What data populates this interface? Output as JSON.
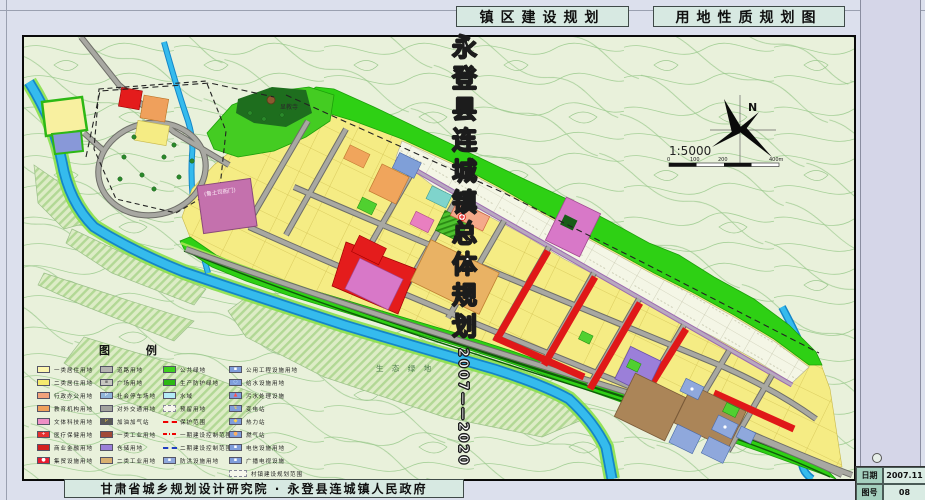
{
  "header": {
    "left_title": "镇区建设规划",
    "right_title": "用地性质规划图"
  },
  "sidebar": {
    "title": "永登县连城镇总体规划",
    "years": "2007——2020",
    "date_label": "日期",
    "date_value": "2007.11",
    "sheet_label": "图号",
    "sheet_value": "08"
  },
  "footer": {
    "credit": "甘肃省城乡规划设计研究院 · 永登县连城镇人民政府"
  },
  "map": {
    "north_label": "N",
    "scale_text": "1:5000",
    "scale_ticks": [
      "0",
      "100",
      "200",
      "400m"
    ],
    "labels": {
      "yamen": "(鲁土司衙门)",
      "temple": "显教寺",
      "eco": "生 态 绿 地"
    },
    "legend": {
      "title": "图    例",
      "columns": [
        {
          "items": [
            {
              "label": "一类居住用地",
              "bg": "#fdf6ae"
            },
            {
              "label": "二类居住用地",
              "bg": "#f5ea6e"
            },
            {
              "label": "行政办公用地",
              "bg": "#f2a27c"
            },
            {
              "label": "教育机构用地",
              "bg": "#efa05c"
            },
            {
              "label": "文体科技用地",
              "bg": "#ee8fc5"
            },
            {
              "label": "医疗保健用地",
              "bg": "#e63030",
              "icon": "+",
              "icon_color": "#ffffff"
            },
            {
              "label": "商业金融用地",
              "bg": "#d42020"
            },
            {
              "label": "集贸设施用地",
              "bg": "#e81c30",
              "icon": "●",
              "icon_color": "#ffffff"
            }
          ]
        },
        {
          "items": [
            {
              "label": "道路用地",
              "bg": "#b4b4b0"
            },
            {
              "label": "广场用地",
              "bg": "#c6c6c0",
              "icon": "▪",
              "icon_color": "#777777"
            },
            {
              "label": "社会停车场地",
              "bg": "#8fb4d8",
              "icon": "P",
              "icon_color": "#ffffff"
            },
            {
              "label": "对外交通用地",
              "bg": "#a2a29e"
            },
            {
              "label": "加油加气站",
              "bg": "#5a5a58",
              "icon": "P",
              "icon_color": "#ffd24a"
            },
            {
              "label": "一类工业用地",
              "bg": "#a04a38"
            },
            {
              "label": "仓储用地",
              "bg": "#9b7fd9"
            },
            {
              "label": "二类工业用地",
              "bg": "#d9b070"
            }
          ]
        },
        {
          "items": [
            {
              "label": "公共绿地",
              "bg": "#3ed01e"
            },
            {
              "label": "生产防护绿地",
              "bg": "#2db814"
            },
            {
              "label": "水域",
              "bg": "#b4ecf6"
            },
            {
              "label": "预留用地",
              "kind": "pale"
            },
            {
              "label": "保护范围",
              "kind": "line"
            },
            {
              "label": "一期建设控制范围",
              "kind": "dashdot"
            },
            {
              "label": "二期建设控制范围",
              "kind": "lineb"
            },
            {
              "label": "防洪设施用地",
              "bg": "#8fa8dc",
              "icon": "▪",
              "icon_color": "#ffffff"
            }
          ]
        },
        {
          "items": [
            {
              "label": "公用工程设施用地",
              "bg": "#7f9ddb",
              "icon": "▪",
              "icon_color": "#ffffff"
            },
            {
              "label": "给水设施用地",
              "bg": "#7f9ddb",
              "icon": "○",
              "icon_color": "#bfe8ff"
            },
            {
              "label": "污水处理设施",
              "bg": "#7f9ddb",
              "icon": "▲",
              "icon_color": "#ff5050"
            },
            {
              "label": "变电站",
              "bg": "#7f9ddb",
              "icon": "↯",
              "icon_color": "#ffd24a"
            },
            {
              "label": "热力站",
              "bg": "#7f9ddb",
              "icon": "◆",
              "icon_color": "#ffd24a"
            },
            {
              "label": "燃气站",
              "bg": "#7f9ddb",
              "icon": "●",
              "icon_color": "#ffb060"
            },
            {
              "label": "电信设施用地",
              "bg": "#7f9ddb",
              "icon": "▪",
              "icon_color": "#ffffff"
            },
            {
              "label": "广播电视设施",
              "bg": "#7f9ddb",
              "icon": "▪",
              "icon_color": "#ffffff"
            },
            {
              "label": "村镇建设规划范围",
              "kind": "pale",
              "wide": true
            }
          ]
        }
      ]
    }
  },
  "palette": {
    "sheet_bg": "#dce0ed",
    "titlebox_bg": "#d7e9e2",
    "sidebar_bg": "#d5d6e8",
    "map_paper": "#e9f1db",
    "contour": "#a6d098",
    "water": "#35bbed",
    "residential_yellow": "#f5ec84",
    "green_belt": "#2ed014",
    "road_gray": "#9c9c96",
    "commercial_red": "#e41c1c",
    "culture_pink": "#d878c8",
    "industry_brown": "#ab8558",
    "warehouse_purple": "#9b7fd9",
    "utility_blue": "#8fa8dc"
  }
}
